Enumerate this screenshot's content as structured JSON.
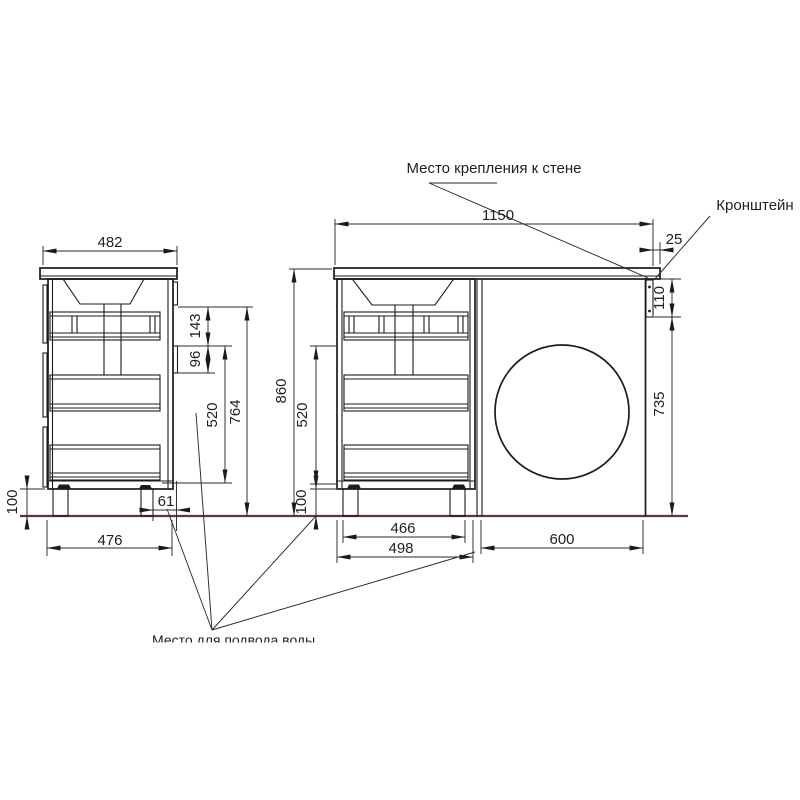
{
  "drawing": {
    "annotations": {
      "wall_mount_label": "Место крепления к стене",
      "bracket_label": "Кронштейн",
      "water_supply_note": "Место для подвода воды"
    },
    "side_view_dims": {
      "top_width": "482",
      "rail_gap": "143",
      "rail_height": "96",
      "drawer_zone_height": "520",
      "rail_to_floor": "764",
      "plinth_height": "100",
      "rear_offset": "61",
      "bottom_depth": "476"
    },
    "front_view_dims": {
      "total_width": "1150",
      "countertop_overhang": "25",
      "bracket_height": "110",
      "side_panel_height": "735",
      "total_height": "860",
      "drawer_zone_height": "520",
      "plinth_height": "100",
      "feet_span": "466",
      "cabinet_width": "498",
      "machine_space_width": "600"
    },
    "colors": {
      "line": "#1b1b1b",
      "floor_line": "#5d3a35"
    }
  }
}
